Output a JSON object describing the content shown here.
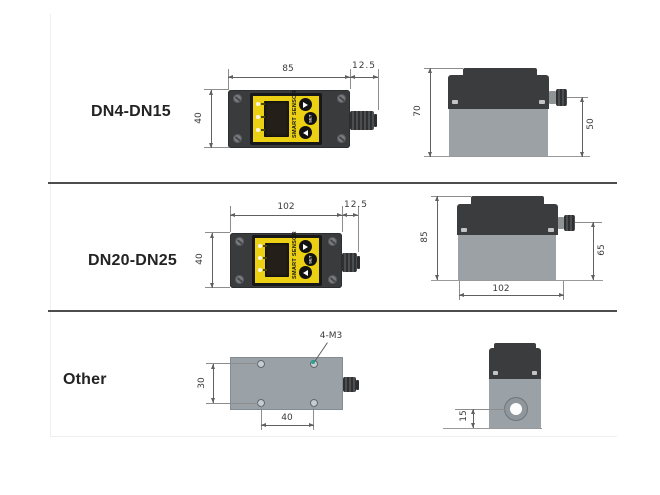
{
  "panel": {
    "brand": "SMART SENSOR",
    "set_label": "SET"
  },
  "rows": [
    {
      "label": "DN4-DN15",
      "top_view": {
        "width": "85",
        "connector_ext": "12.5",
        "depth": "40"
      },
      "side_view": {
        "height": "70",
        "body_height": "50"
      }
    },
    {
      "label": "DN20-DN25",
      "top_view": {
        "width": "102",
        "connector_ext": "12.5",
        "depth": "40"
      },
      "side_view": {
        "height": "85",
        "body_height": "65",
        "width": "102"
      }
    },
    {
      "label": "Other",
      "top_view": {
        "hole_spacing_v": "30",
        "hole_spacing_h": "40",
        "hole_callout": "4-M3"
      },
      "side_view": {
        "port_center_to_bottom": "15"
      }
    }
  ],
  "colors": {
    "panel_yellow": "#ecd013",
    "housing_dark": "#3b3c3e",
    "body_gray": "#9ba1a4",
    "plate_gray": "#9aa2a8",
    "separator": "#4b4d4f",
    "dimension_line": "#606060",
    "lcd": "#241f18",
    "callout_teal": "#2aa390"
  }
}
